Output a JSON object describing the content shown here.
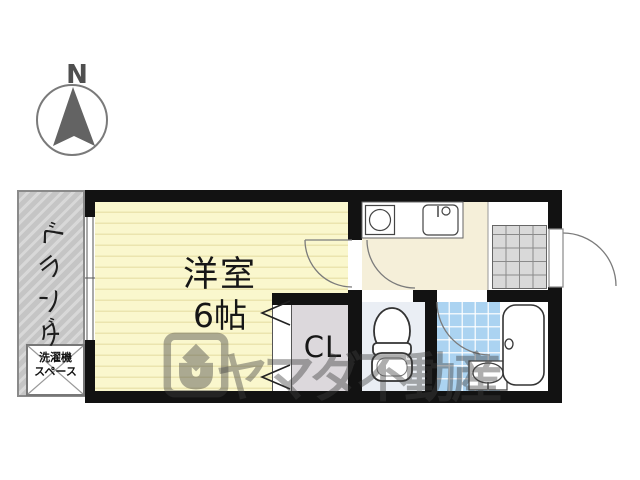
{
  "compass": {
    "label": "N"
  },
  "floorplan": {
    "main_room": {
      "name": "洋室",
      "size": "6帖"
    },
    "closet": {
      "label": "CL"
    },
    "veranda": {
      "label": "ベランダ",
      "chars": [
        "ベ",
        "ラ",
        "ン",
        "ダ"
      ]
    },
    "laundry": {
      "line1": "洗濯機",
      "line2": "スペース"
    },
    "icons": {
      "compass_needle": "north-arrow-icon",
      "stove": "stove-burner-icon",
      "sink": "kitchen-sink-icon",
      "toilet": "toilet-icon",
      "washbasin": "washbasin-icon",
      "bathtub": "bathtub-icon",
      "closet_doors": "bifold-door-chevrons",
      "entrance_door": "entrance-door-swing"
    },
    "colors": {
      "wall": "#121212",
      "room_yellow": "#faf7cd",
      "room_line": "#ebe4ae",
      "kitchen_cream": "#f5efd9",
      "bath_tile_blue": "#abd3f1",
      "genkan_tile_gray": "#d9d9d9",
      "closet_gray": "#dcd8dc",
      "toilet_gray_blue": "#eaeef4",
      "veranda_gray": "#c5c5c5",
      "watermark_gray": "#3f3f3f"
    }
  },
  "watermark": {
    "text": "ヤマダ不動産"
  }
}
